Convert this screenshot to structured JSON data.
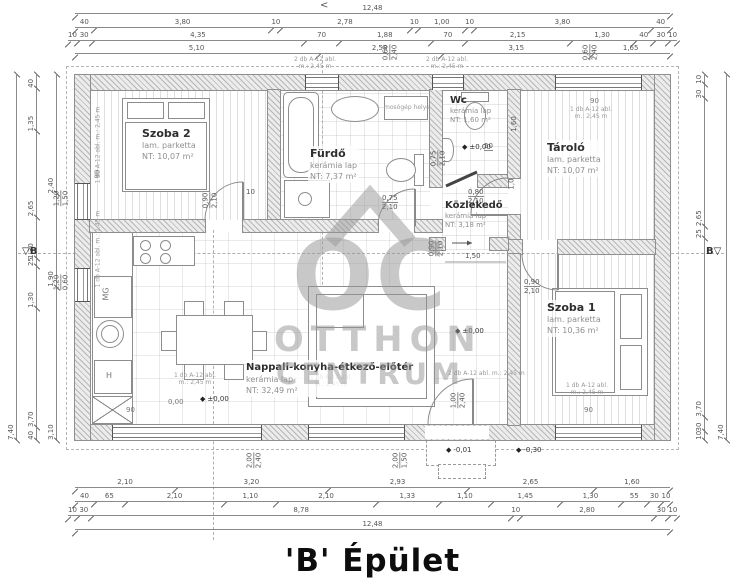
{
  "title": "'B' Épület",
  "top_arrow": "<",
  "section_marker": "B",
  "watermark": {
    "oc": "OC",
    "line2": "OTTHON",
    "line3": "CENTRUM"
  },
  "rooms": {
    "szoba2": {
      "name": "Szoba 2",
      "floor": "lam. parketta",
      "area": "NT: 10,07 m²"
    },
    "furdo": {
      "name": "Fürdő",
      "floor": "kerámia lap",
      "area": "NT: 7,37 m²"
    },
    "wc": {
      "name": "Wc",
      "floor": "kerámia lap",
      "area": "NT: 1,60 m²"
    },
    "tarolo": {
      "name": "Tároló",
      "floor": "lam. parketta",
      "area": "NT: 10,07 m²"
    },
    "kozlekedo": {
      "name": "Közlekedő",
      "floor": "kerámia lap",
      "area": "NT: 3,18 m²"
    },
    "szoba1": {
      "name": "Szoba 1",
      "floor": "lam. parketta",
      "area": "NT: 10,36 m²"
    },
    "nappali": {
      "name": "Nappali-konyha-étkező-előtér",
      "floor": "kerámia lap",
      "area": "NT: 32,49 m²"
    }
  },
  "fixtures": {
    "mg": "MG",
    "h": "H"
  },
  "levels": {
    "zero": "±0,00",
    "zero_plain": "0,00",
    "minus1": "-0,01",
    "minus30": "-0,30"
  },
  "dims": {
    "top": {
      "total": "12,48",
      "row2": [
        "40",
        "3,80",
        "10",
        "2,78",
        "10",
        "1,00",
        "10",
        "3,80",
        "40"
      ],
      "row3": [
        "10",
        "30",
        "4,35",
        "70",
        "1,88",
        "70",
        "2,15",
        "1,30",
        "40",
        "30",
        "10"
      ],
      "row4": [
        "5,10",
        "2,58",
        "3,15",
        "1,65"
      ]
    },
    "bottom": {
      "row1": [
        "2,10",
        "3,20",
        "2,93",
        "2,65",
        "1,60"
      ],
      "row2": [
        "40",
        "65",
        "2,10",
        "1,10",
        "2,10",
        "1,33",
        "1,10",
        "1,45",
        "1,30",
        "55",
        "30",
        "10"
      ],
      "row3": [
        "10",
        "30",
        "8,78",
        "10",
        "2,80",
        "30",
        "10"
      ],
      "total": "12,48"
    },
    "left": {
      "total": "7,40",
      "mid": [
        "40",
        "1,35",
        "2,65",
        "1,30",
        "25",
        "1,30",
        "3,70",
        "40"
      ],
      "inner": [
        "2,40",
        "1,90",
        "3,10"
      ]
    },
    "right": {
      "chain": [
        "10",
        "30",
        "2,65",
        "25",
        "3,70",
        "30",
        "10"
      ],
      "total": "7,40"
    },
    "doors": {
      "szoba2": [
        "0,90",
        "2,10"
      ],
      "furdo": [
        "0,75",
        "2,10"
      ],
      "wc": [
        "0,75",
        "2,10"
      ],
      "tarolo": [
        "0,80",
        "2,10"
      ],
      "szoba1": [
        "0,90",
        "2,10"
      ],
      "kozlekedo": [
        "0,90",
        "2,10"
      ],
      "entry": [
        "1,00",
        "2,40"
      ]
    },
    "windows": {
      "left_upper": [
        "1,20",
        "1,50"
      ],
      "left_lower": [
        "1,20",
        "0,60"
      ],
      "bottom_large": [
        "2,00",
        "2,40"
      ],
      "bottom_small": [
        "2,00",
        "1,50"
      ],
      "top_small": [
        "0,60",
        "2,40"
      ]
    },
    "inner": {
      "d150": "1,50",
      "d160": "1,60",
      "d100": "1,0",
      "d50": "50",
      "d10": "10",
      "sill": "90"
    }
  },
  "notes": {
    "n1a": "1 db A-12 abl.",
    "n1b": "m.: 2,45 m",
    "n2a": "2 db A-12 abl.",
    "n2b": "m.: 2,45 m",
    "n3a": "1 db A-12 abl.",
    "n3b": "m.: 1,45 m",
    "washer": "mosógép helye"
  }
}
